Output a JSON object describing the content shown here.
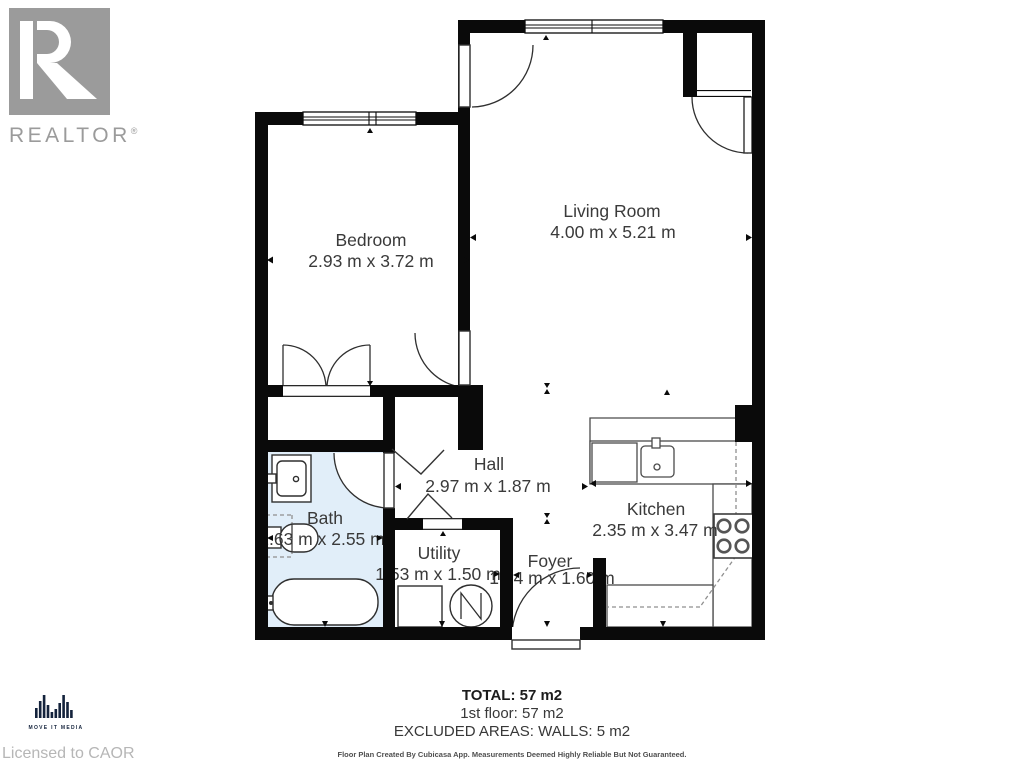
{
  "branding": {
    "realtor_logo_text": "REALTOR",
    "realtor_registered": "®",
    "media_logo_text": "MOVE IT MEDIA",
    "licensed_text": "Licensed to CAOR"
  },
  "rooms": [
    {
      "name": "Bedroom",
      "dims": "2.93 m x 3.72 m"
    },
    {
      "name": "Living Room",
      "dims": "4.00 m x 5.21 m"
    },
    {
      "name": "Hall",
      "dims": "2.97 m x 1.87 m"
    },
    {
      "name": "Bath",
      "dims": "1.63 m x 2.55 m"
    },
    {
      "name": "Utility",
      "dims": "1.53 m x 1.50 m"
    },
    {
      "name": "Foyer",
      "dims": "1.34 m x 1.60 m"
    },
    {
      "name": "Kitchen",
      "dims": "2.35 m x 3.47 m"
    }
  ],
  "summary": {
    "total": "TOTAL: 57 m2",
    "floor": "1st floor: 57 m2",
    "excluded": "EXCLUDED AREAS: WALLS: 5 m2",
    "disclaimer": "Floor Plan Created By Cubicasa App. Measurements Deemed Highly Reliable But Not Guaranteed."
  },
  "legend_symbols": [
    "window",
    "door-swing",
    "opening-arrow",
    "bath-vanity",
    "toilet",
    "bathtub",
    "washer",
    "water-heater",
    "dishwasher",
    "kitchen-sink",
    "stove",
    "counter"
  ],
  "colors": {
    "wall": "#0a0a0a",
    "bath_fill": "#e1eef9",
    "label_text": "#3a3a3a",
    "realtor_gray": "#9b9b9b",
    "media_navy": "#14233c",
    "licensed_gray": "#b6b6b6"
  }
}
